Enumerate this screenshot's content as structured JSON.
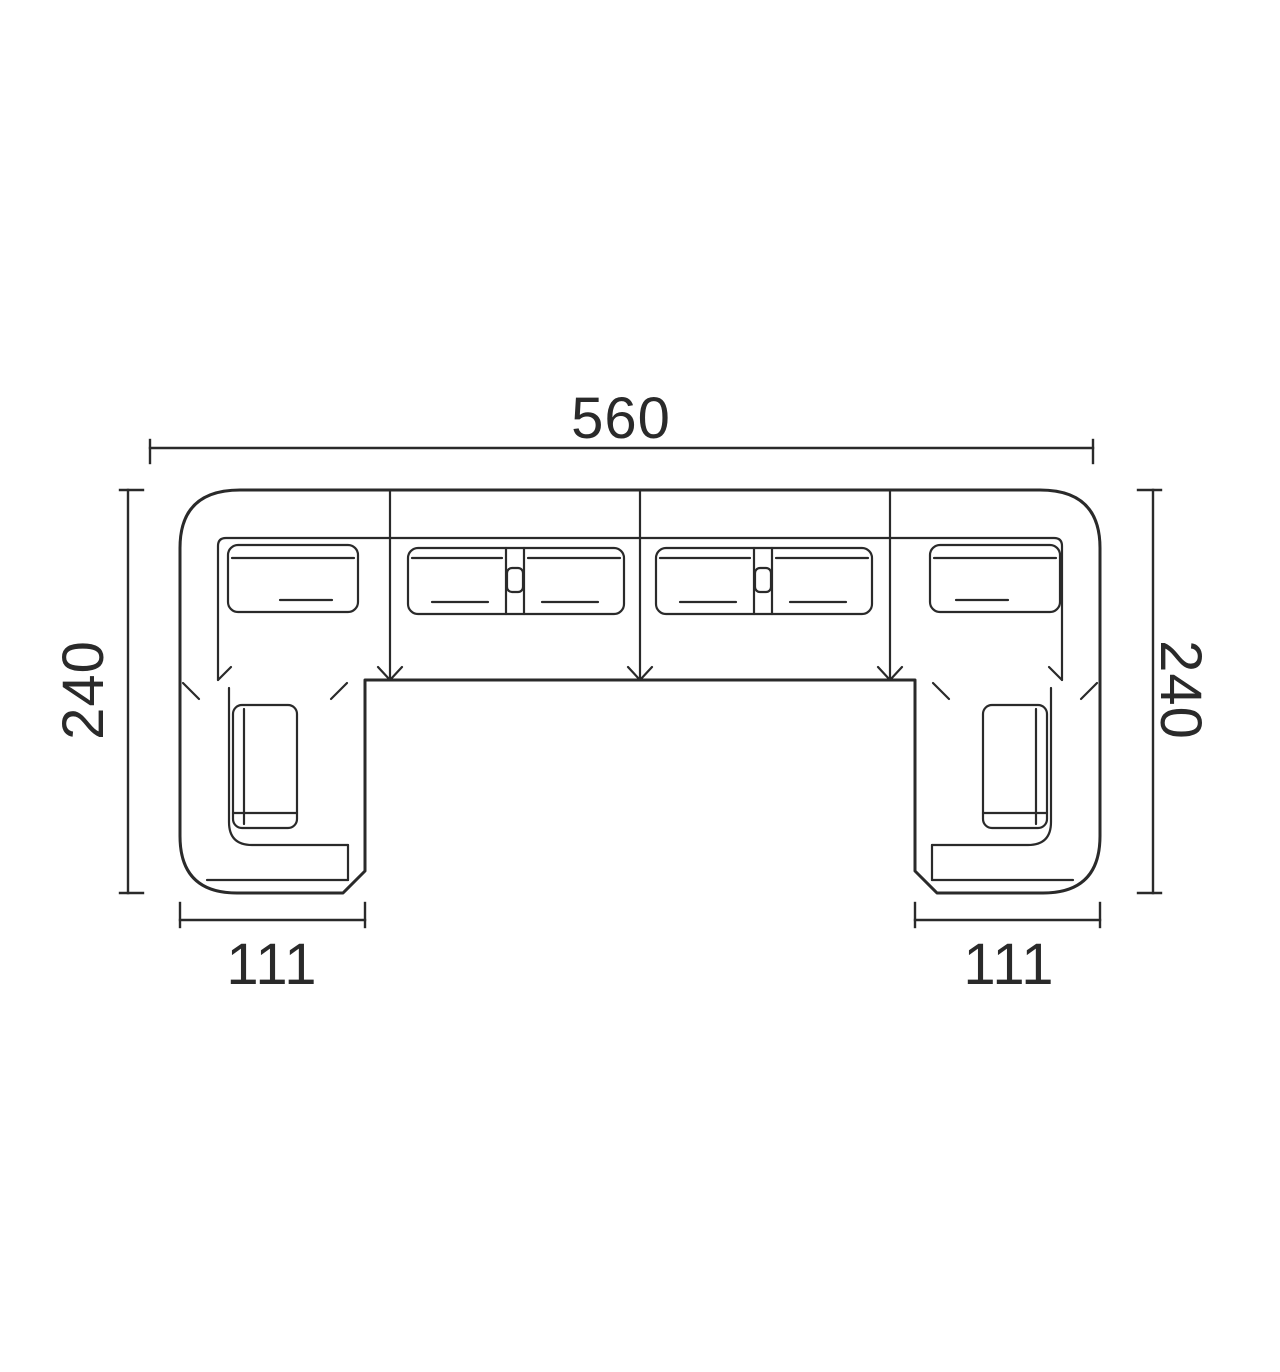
{
  "diagram": {
    "subject": "u-shaped-sectional-sofa-top-view",
    "style": "technical-dimension-drawing",
    "colors": {
      "line": "#2a2a2a",
      "background": "#ffffff"
    },
    "labels": {
      "overall_width": "560",
      "depth_left": "240",
      "depth_right": "240",
      "chaise_left_width": "111",
      "chaise_right_width": "111"
    }
  }
}
